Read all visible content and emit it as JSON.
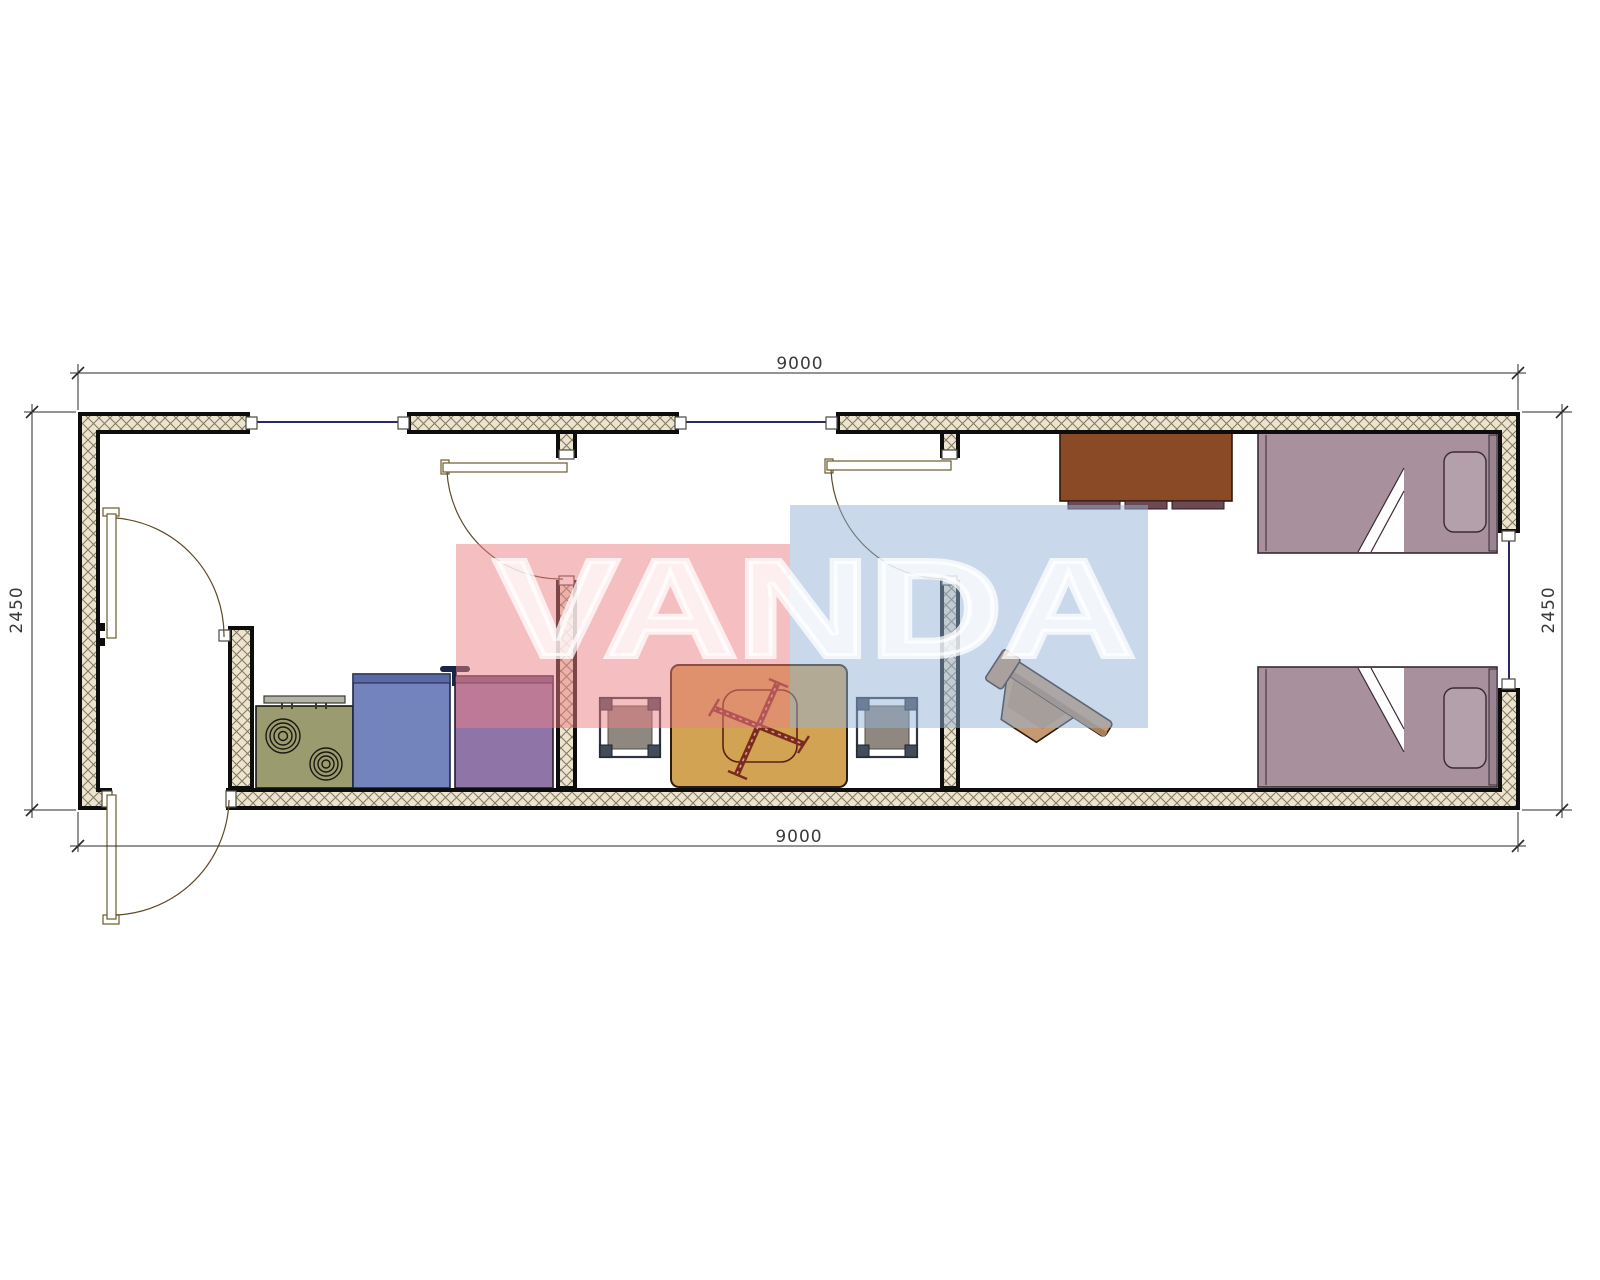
{
  "drawing": {
    "type": "floor-plan",
    "dimensions": {
      "top_width": "9000",
      "bottom_width": "9000",
      "left_height": "2450",
      "right_height": "2450"
    },
    "watermark": {
      "text": "VANDA",
      "pink_block_color": "#eb8085",
      "blue_block_color": "#94b2d6",
      "text_color": "#ffffff"
    },
    "palette": {
      "wall_hatch_bg": "#ece4cf",
      "wall_hatch_line": "#857b62",
      "wall_border": "#0d0d0d",
      "window_line": "#2a2a60",
      "door_line": "#6b5a2a",
      "stove": "#9b9b70",
      "sink_cabinet": "#7383bb",
      "kitchen_cabinet": "#8f74a8",
      "table": "#d1a352",
      "stool": "#8e8881",
      "wardrobe": "#8a4a26",
      "bed": "#a8909c",
      "chair": "#c59a73"
    }
  }
}
